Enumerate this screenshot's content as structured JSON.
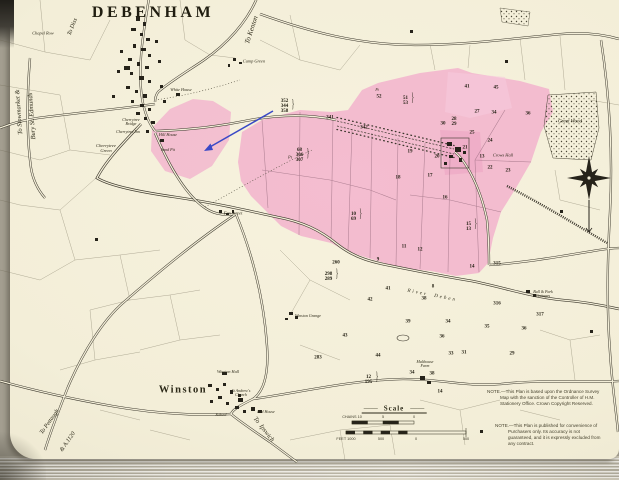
{
  "map": {
    "title": "DEBENHAM",
    "colors": {
      "paper": "#f3eed8",
      "pink": "#f2afcc",
      "pink_light": "#f7c9dc",
      "ink": "#3a362b",
      "blue_arrow": "#3a49c6"
    },
    "notes": {
      "survey": "NOTE.—This Plan is based upon the Ordnance Survey Map with the sanction of the Controller of H.M. Stationery Office. Crown Copyright Reserved.",
      "purchasers": "NOTE.—This Plan is published for convenience of Purchasers only. Its accuracy is not guaranteed, and it is expressly excluded from any contract."
    },
    "scale": {
      "label": "Scale",
      "chains_ticks": [
        "CHAINS 10",
        "5",
        "0"
      ],
      "feet_ticks": [
        "FEET 1000",
        "500",
        "0",
        "500"
      ]
    },
    "place_labels": [
      {
        "t": "To Diss",
        "x": 73,
        "y": 27,
        "r": -68,
        "s": 6,
        "i": 1
      },
      {
        "t": "To Kenton",
        "x": 252,
        "y": 30,
        "r": -72,
        "s": 7,
        "i": 1
      },
      {
        "t": "To Stowmarket &",
        "x": 20,
        "y": 112,
        "r": -94,
        "s": 6.5,
        "i": 1
      },
      {
        "t": "Bury St. Edmunds",
        "x": 33,
        "y": 116,
        "r": -94,
        "s": 6.5,
        "i": 1
      },
      {
        "t": "Chapel Row",
        "x": 43,
        "y": 34,
        "s": 4.4,
        "i": 1
      },
      {
        "t": "Camp Green",
        "x": 254,
        "y": 62,
        "s": 4.4,
        "i": 1
      },
      {
        "t": "White House",
        "x": 181,
        "y": 90,
        "s": 4.2,
        "i": 1
      },
      {
        "t": "Hill House",
        "x": 168,
        "y": 135,
        "s": 4.2,
        "i": 1
      },
      {
        "t": "Cherrytree\nBridge",
        "x": 131,
        "y": 122,
        "s": 4,
        "i": 1
      },
      {
        "t": "Cherrytree Inn",
        "x": 128,
        "y": 132,
        "s": 4,
        "i": 1
      },
      {
        "t": "Cherrytree\nGreen",
        "x": 106,
        "y": 149,
        "s": 4.6,
        "i": 1
      },
      {
        "t": "Sand Pit",
        "x": 168,
        "y": 150,
        "s": 4,
        "i": 1
      },
      {
        "t": "Fen Street",
        "x": 233,
        "y": 214,
        "s": 4.6,
        "i": 1
      },
      {
        "t": "River  Deben",
        "x": 432,
        "y": 296,
        "r": 11,
        "s": 5,
        "i": 1,
        "sp": 2
      },
      {
        "t": "Winston",
        "x": 183,
        "y": 391,
        "s": 10.5,
        "b": 1,
        "sp": 1.5
      },
      {
        "t": "Winston Hall",
        "x": 228,
        "y": 372,
        "s": 4.2,
        "i": 1
      },
      {
        "t": "St Andrew's\nChurch",
        "x": 241,
        "y": 393,
        "s": 4,
        "i": 1
      },
      {
        "t": "School",
        "x": 221,
        "y": 415,
        "s": 4,
        "i": 1
      },
      {
        "t": "Red House",
        "x": 266,
        "y": 412,
        "s": 4,
        "i": 1
      },
      {
        "t": "To  Ipswich",
        "x": 263,
        "y": 430,
        "r": 52,
        "s": 6.5,
        "i": 1
      },
      {
        "t": "To Pettaugh",
        "x": 50,
        "y": 422,
        "r": -55,
        "s": 6,
        "i": 1
      },
      {
        "t": "& A.1120",
        "x": 68,
        "y": 442,
        "r": -55,
        "s": 6,
        "i": 1
      },
      {
        "t": "Malthouse\nFarm",
        "x": 425,
        "y": 364,
        "s": 4,
        "i": 1
      },
      {
        "t": "Bull & Park\nCottages",
        "x": 543,
        "y": 294,
        "s": 4,
        "i": 1
      },
      {
        "t": "Crows Hall",
        "x": 503,
        "y": 156,
        "s": 4.4,
        "i": 1
      },
      {
        "t": "Great Wood",
        "x": 570,
        "y": 122,
        "s": 5,
        "i": 1
      },
      {
        "t": "Winston Grange",
        "x": 308,
        "y": 316,
        "s": 4,
        "i": 1
      },
      {
        "t": "Pt",
        "x": 290,
        "y": 158,
        "s": 4.4,
        "i": 1
      },
      {
        "t": "Pt",
        "x": 377,
        "y": 91,
        "s": 3.8,
        "i": 1
      }
    ],
    "parcel_numbers": [
      {
        "t": "352\n344\n358",
        "x": 286,
        "y": 107,
        "br": 1
      },
      {
        "t": "341",
        "x": 330,
        "y": 118
      },
      {
        "t": "342",
        "x": 364,
        "y": 128
      },
      {
        "t": "52",
        "x": 379,
        "y": 97
      },
      {
        "t": "51\n53",
        "x": 407,
        "y": 101,
        "br": 1
      },
      {
        "t": "68\n306\n307",
        "x": 301,
        "y": 156,
        "br": 1
      },
      {
        "t": "41",
        "x": 467,
        "y": 87
      },
      {
        "t": "45",
        "x": 496,
        "y": 88
      },
      {
        "t": "30",
        "x": 443,
        "y": 124
      },
      {
        "t": "28\n29",
        "x": 454,
        "y": 122
      },
      {
        "t": "27",
        "x": 477,
        "y": 112
      },
      {
        "t": "34",
        "x": 494,
        "y": 113
      },
      {
        "t": "36",
        "x": 528,
        "y": 114
      },
      {
        "t": "25",
        "x": 472,
        "y": 133
      },
      {
        "t": "24",
        "x": 490,
        "y": 141
      },
      {
        "t": "21",
        "x": 465,
        "y": 148
      },
      {
        "t": "13",
        "x": 482,
        "y": 157
      },
      {
        "t": "22",
        "x": 490,
        "y": 168
      },
      {
        "t": "23",
        "x": 508,
        "y": 171
      },
      {
        "t": "20",
        "x": 437,
        "y": 157
      },
      {
        "t": "19",
        "x": 410,
        "y": 152
      },
      {
        "t": "18",
        "x": 398,
        "y": 178
      },
      {
        "t": "17",
        "x": 430,
        "y": 176
      },
      {
        "t": "16",
        "x": 445,
        "y": 198
      },
      {
        "t": "10\n69",
        "x": 355,
        "y": 217,
        "br": 1
      },
      {
        "t": "15\n13",
        "x": 470,
        "y": 227,
        "br": 1
      },
      {
        "t": "11",
        "x": 404,
        "y": 247
      },
      {
        "t": "12",
        "x": 420,
        "y": 250
      },
      {
        "t": "14",
        "x": 472,
        "y": 267
      },
      {
        "t": "315",
        "x": 497,
        "y": 264
      },
      {
        "t": "9",
        "x": 378,
        "y": 260
      },
      {
        "t": "8",
        "x": 433,
        "y": 287
      },
      {
        "t": "260",
        "x": 336,
        "y": 263
      },
      {
        "t": "298\n289",
        "x": 330,
        "y": 277,
        "br": 1
      },
      {
        "t": "41",
        "x": 388,
        "y": 289
      },
      {
        "t": "42",
        "x": 370,
        "y": 300
      },
      {
        "t": "38",
        "x": 424,
        "y": 299
      },
      {
        "t": "39",
        "x": 408,
        "y": 322
      },
      {
        "t": "43",
        "x": 345,
        "y": 336
      },
      {
        "t": "283",
        "x": 318,
        "y": 358
      },
      {
        "t": "44",
        "x": 378,
        "y": 356
      },
      {
        "t": "34",
        "x": 448,
        "y": 322
      },
      {
        "t": "36",
        "x": 442,
        "y": 337
      },
      {
        "t": "33",
        "x": 451,
        "y": 354
      },
      {
        "t": "34",
        "x": 412,
        "y": 373
      },
      {
        "t": "38",
        "x": 432,
        "y": 374
      },
      {
        "t": "14",
        "x": 440,
        "y": 392
      },
      {
        "t": "316",
        "x": 497,
        "y": 304
      },
      {
        "t": "317",
        "x": 540,
        "y": 315
      },
      {
        "t": "35",
        "x": 487,
        "y": 327
      },
      {
        "t": "36",
        "x": 524,
        "y": 329
      },
      {
        "t": "31",
        "x": 464,
        "y": 353
      },
      {
        "t": "29",
        "x": 512,
        "y": 354
      },
      {
        "t": "12\n195",
        "x": 370,
        "y": 380,
        "br": 1
      }
    ]
  }
}
